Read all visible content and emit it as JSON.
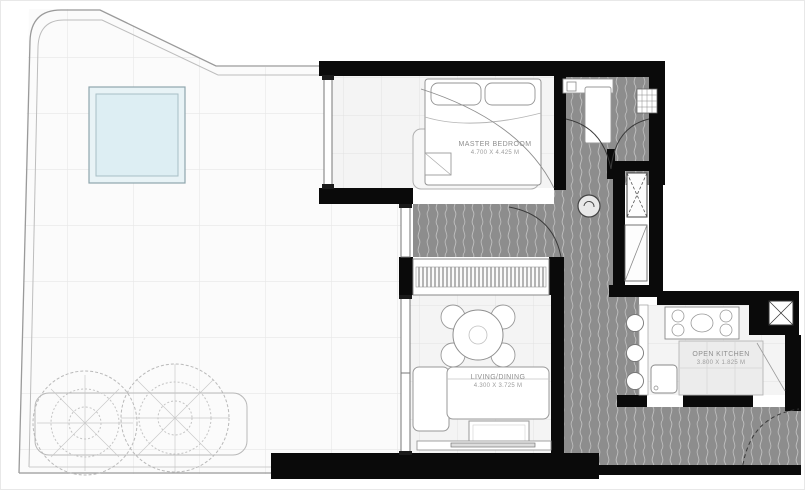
{
  "plan": {
    "rooms": [
      {
        "id": "master-bedroom",
        "label": "MASTER BEDROOM",
        "dimensions": "4.700 x 4.425 m"
      },
      {
        "id": "living-dining",
        "label": "LIVING/DINING",
        "dimensions": "4.300 x 3.725 m"
      },
      {
        "id": "open-kitchen",
        "label": "OPEN KITCHEN",
        "dimensions": "3.800 x 1.825 m"
      }
    ],
    "colors": {
      "wall": "#0a0a0a",
      "corridor_floor": "#8d8d8d",
      "corridor_wave_line": "#c0c0c0",
      "pool_water": "#ddeef3",
      "drawing_line": "#999999",
      "room_floor": "#f4f4f4"
    }
  }
}
